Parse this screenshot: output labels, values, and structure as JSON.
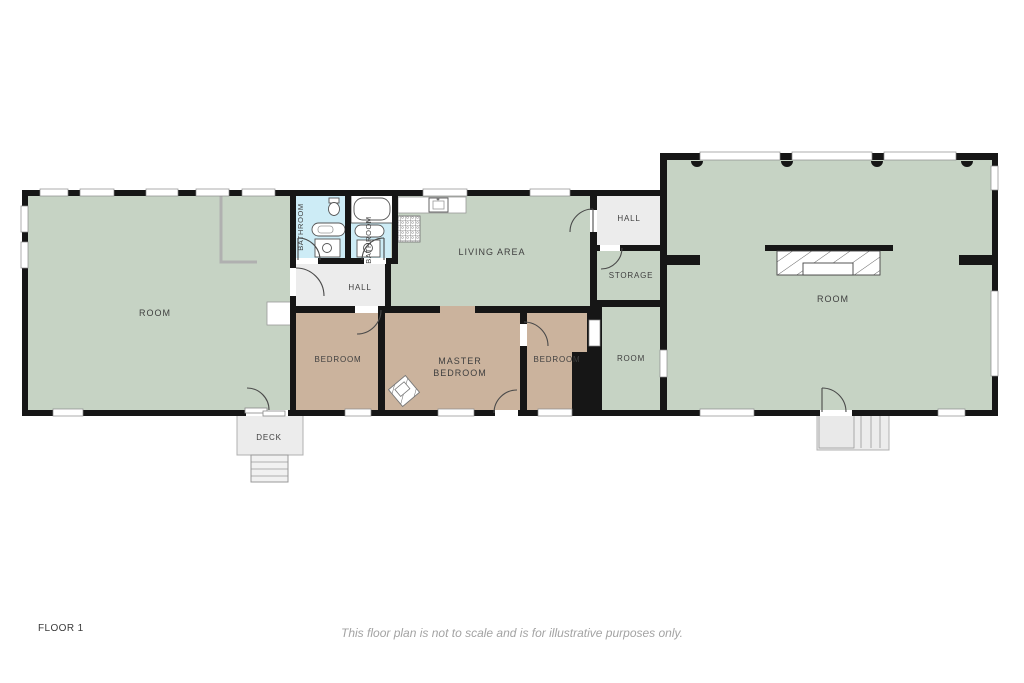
{
  "page": {
    "floor_label": "FLOOR 1",
    "disclaimer": "This floor plan is not to scale and is for illustrative purposes only."
  },
  "colors": {
    "room_green": "#c6d3c4",
    "bedroom_tan": "#cbb39d",
    "bathroom_blue": "#cdecf6",
    "hall_grey": "#ececec",
    "deck_grey": "#ececec",
    "wall_black": "#161616",
    "label_text": "#3f3f3f",
    "disclaimer_text": "#a3a3a3"
  },
  "rooms": {
    "room_left": {
      "label": "ROOM"
    },
    "bathroom_1": {
      "label": "BATHROOM"
    },
    "bathroom_2": {
      "label": "BATHROOM"
    },
    "hall_1": {
      "label": "HALL"
    },
    "living_area": {
      "label": "LIVING AREA"
    },
    "bedroom_1": {
      "label": "BEDROOM"
    },
    "master_bedroom": {
      "line1": "MASTER",
      "line2": "BEDROOM"
    },
    "bedroom_2": {
      "label": "BEDROOM"
    },
    "hall_2": {
      "label": "HALL"
    },
    "storage": {
      "label": "STORAGE"
    },
    "room_middle": {
      "label": "ROOM"
    },
    "room_right": {
      "label": "ROOM"
    },
    "deck": {
      "label": "DECK"
    }
  },
  "icons": {
    "bathtub": "rounded-rect outline",
    "sink": "square with basin circle",
    "toilet": "ellipse with tank",
    "stove": "grid-pattern square",
    "fireplace": "hatched rectangle",
    "stairs": "parallel tread lines",
    "door": "quarter-circle swing arc",
    "window": "white wall segment"
  }
}
